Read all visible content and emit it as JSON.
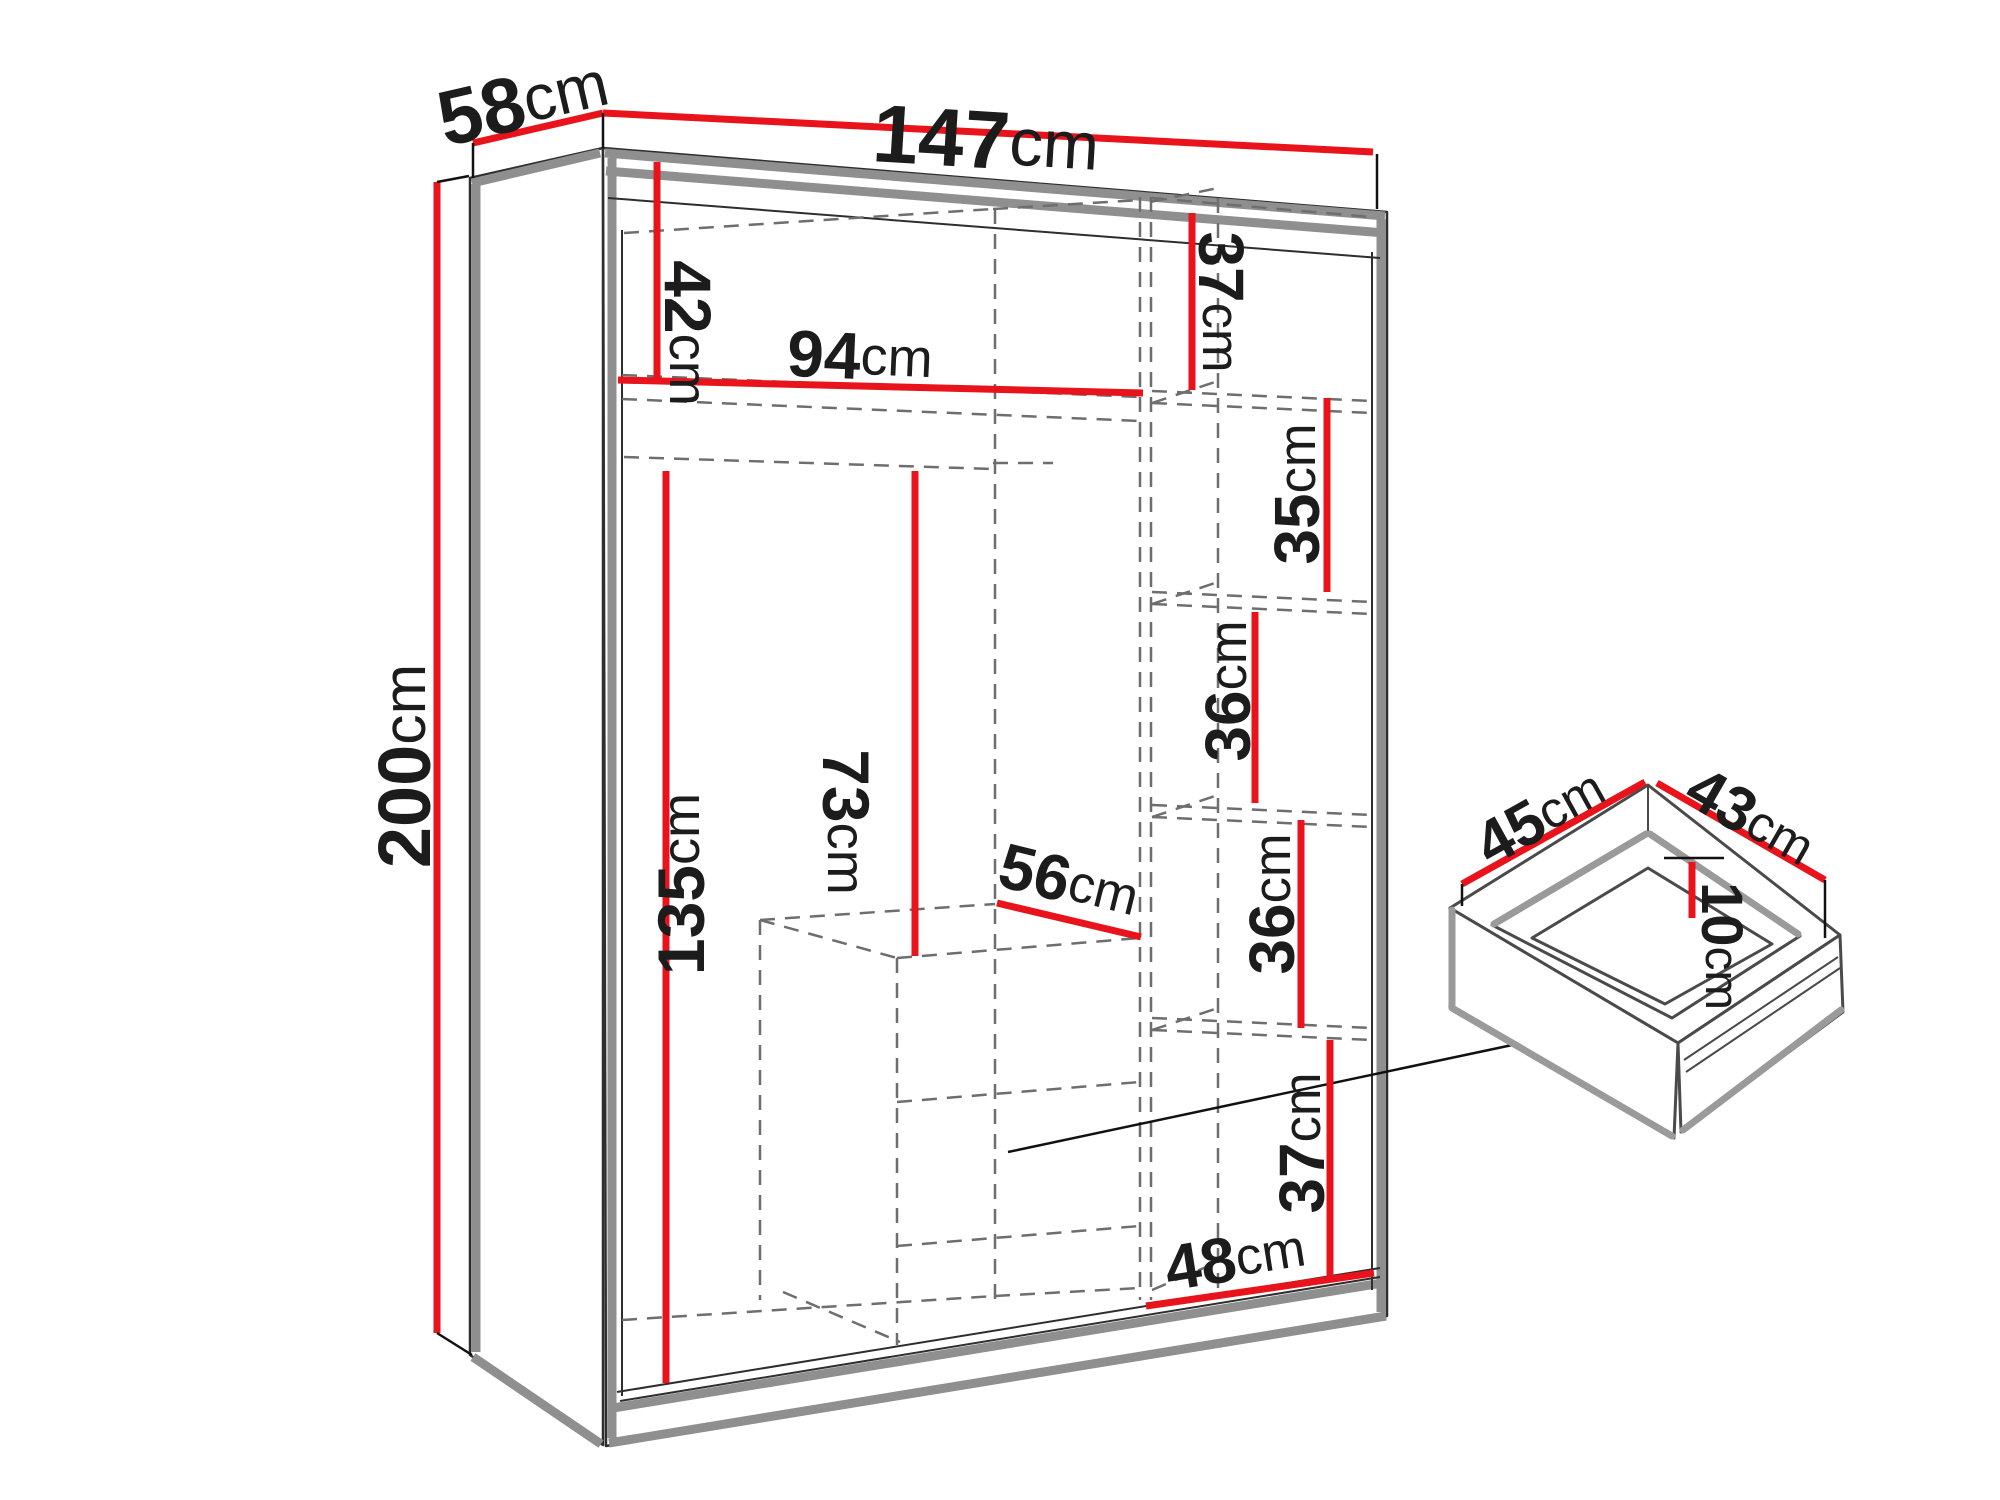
{
  "diagram": {
    "type": "furniture-dimension-diagram",
    "product": "sliding-door wardrobe with interior shelves and drawer unit, plus detail view of a drawer",
    "unit": "cm",
    "colors": {
      "dimension_line": "#e8131b",
      "outline": "#2e2e2e",
      "accent_gray": "#8f8f8f",
      "dashed_interior": "#6e6e6e",
      "text": "#1c1c1c",
      "background": "#ffffff"
    }
  },
  "wardrobe": {
    "overall": {
      "width": {
        "num": "147",
        "unit": "cm"
      },
      "depth": {
        "num": "58",
        "unit": "cm"
      },
      "height": {
        "num": "200",
        "unit": "cm"
      }
    },
    "interior": {
      "top_left_compartment_height": {
        "num": "42",
        "unit": "cm"
      },
      "left_section_width": {
        "num": "94",
        "unit": "cm"
      },
      "hanging_height_left": {
        "num": "135",
        "unit": "cm"
      },
      "hanging_height_middle": {
        "num": "73",
        "unit": "cm"
      },
      "drawer_unit_width": {
        "num": "56",
        "unit": "cm"
      },
      "right_shelf_1_height": {
        "num": "37",
        "unit": "cm"
      },
      "right_shelf_2_height": {
        "num": "35",
        "unit": "cm"
      },
      "right_shelf_3_height": {
        "num": "36",
        "unit": "cm"
      },
      "right_shelf_4_height": {
        "num": "36",
        "unit": "cm"
      },
      "right_shelf_5_height": {
        "num": "37",
        "unit": "cm"
      },
      "right_section_width": {
        "num": "48",
        "unit": "cm"
      }
    }
  },
  "drawer_detail": {
    "width": {
      "num": "45",
      "unit": "cm"
    },
    "depth": {
      "num": "43",
      "unit": "cm"
    },
    "inner_height": {
      "num": "10",
      "unit": "cm"
    }
  }
}
